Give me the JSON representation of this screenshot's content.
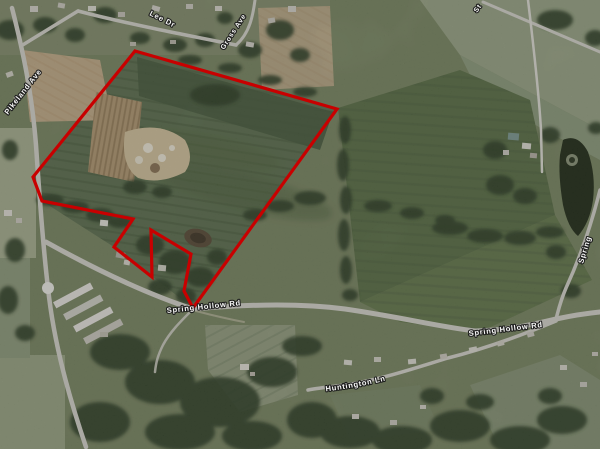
{
  "image_type": "aerial-satellite-map",
  "map": {
    "description": "Aerial photograph with red parcel boundary overlay near Spring Hollow Rd and Pikeland Ave",
    "road_labels": {
      "pikeland": {
        "text": "Pikeland Ave"
      },
      "lee": {
        "text": "Lee Dr"
      },
      "gross": {
        "text": "Gross Ave"
      },
      "st_partial": {
        "text": "St"
      },
      "spring_hollow_west": {
        "text": "Spring Hollow Rd"
      },
      "spring_hollow_east": {
        "text": "Spring Hollow Rd"
      },
      "huntington": {
        "text": "Huntington Ln"
      },
      "spring_partial": {
        "text": "Spring"
      }
    },
    "parcel": {
      "outline_color": "#c80000",
      "outline_width": 3.2,
      "points_str": "135,51 337,109 193,308 184,291 191,254 151,230 152,277 114,247 133,219 42,201 33,177",
      "points": [
        [
          135,
          51
        ],
        [
          337,
          109
        ],
        [
          193,
          308
        ],
        [
          184,
          291
        ],
        [
          191,
          254
        ],
        [
          151,
          230
        ],
        [
          152,
          277
        ],
        [
          114,
          247
        ],
        [
          133,
          219
        ],
        [
          42,
          201
        ],
        [
          33,
          177
        ]
      ]
    },
    "label_style": {
      "fill": "#fdfdfd",
      "halo": "#1a1a1a"
    }
  }
}
